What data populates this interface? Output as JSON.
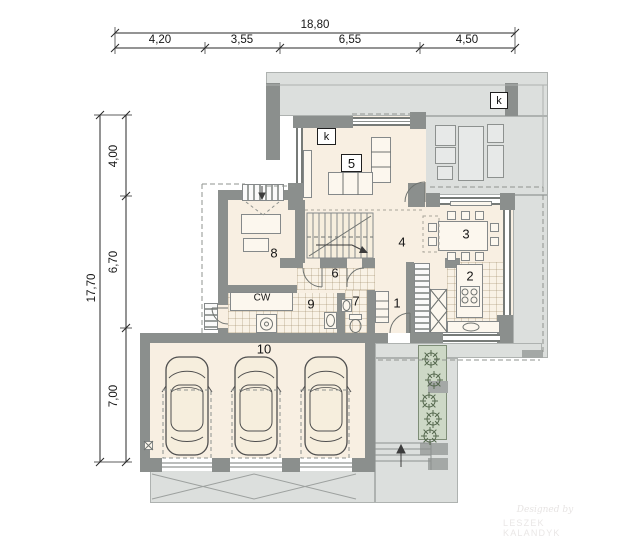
{
  "dimensions": {
    "top_total": "18,80",
    "top_segments": [
      "4,20",
      "3,55",
      "6,55",
      "4,50"
    ],
    "left_total": "17,70",
    "left_segments": [
      "4,00",
      "6,70",
      "7,00"
    ]
  },
  "rooms": {
    "r1": "1",
    "r2": "2",
    "r3": "3",
    "r4": "4",
    "r5": "5",
    "r6": "6",
    "r7": "7",
    "r8": "8",
    "r9": "9",
    "r10": "10"
  },
  "marks": {
    "chimney_top": "k",
    "chimney_living": "k",
    "hot_water": "CW"
  },
  "watermark": {
    "line1": "Designed by",
    "line2": "LESZEK KALANDYK"
  },
  "colors": {
    "wall": "#8b8f8d",
    "floor": "#f8efe2",
    "paving": "#dcdfdd",
    "planter": "#cdd8c6",
    "line": "#777b78"
  }
}
